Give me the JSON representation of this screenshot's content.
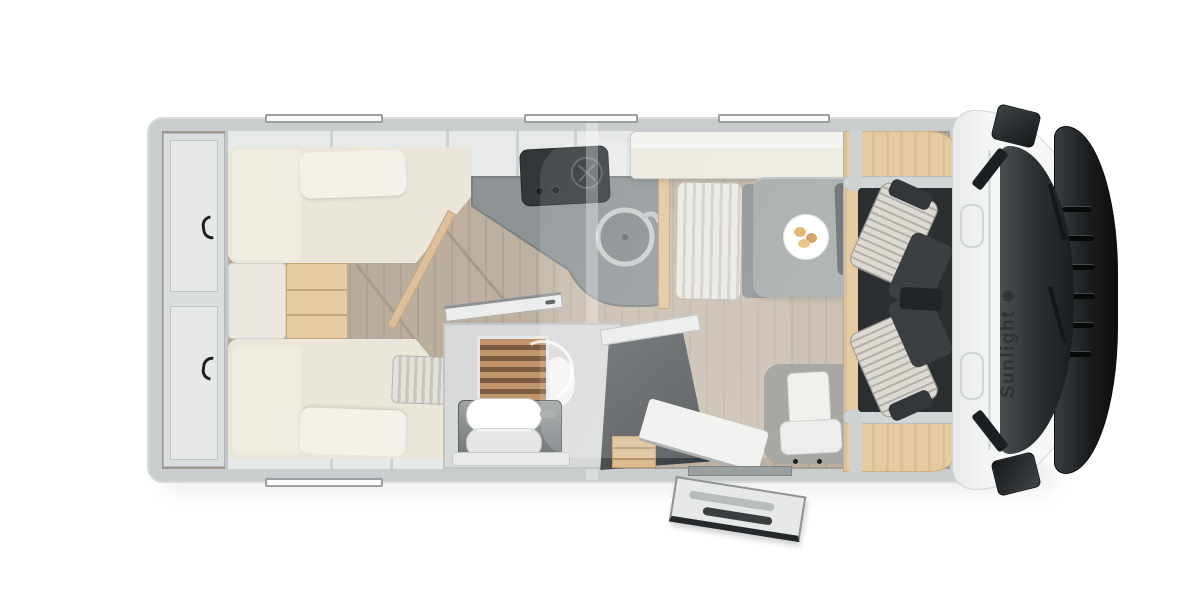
{
  "image": {
    "kind": "motorhome-floorplan-top-view",
    "background": "#ffffff"
  },
  "brand": {
    "logo_text": "Sunlight",
    "logo_icon": "sun-icon",
    "logo_icon_glyph": "❋",
    "logo_color": "#2f3335"
  },
  "colors": {
    "body_wall": "#c9cdce",
    "floor_wood": "#b8ab9c",
    "furniture_cream": "#eae6da",
    "accent_beech": "#e5cba3",
    "kitchen_counter": "#8d9395",
    "dark_charcoal": "#3b3f41",
    "cab_front_dark": "#17191b",
    "upholstery_stripe_light": "#dbd9d2",
    "shower_teak": "#a97f5e"
  },
  "furniture_zones": [
    "rear-storage",
    "twin-bed-top",
    "twin-bed-bottom",
    "bed-steps",
    "overhead-cabinets",
    "kitchen-counter",
    "cooktop",
    "round-sink",
    "bathroom",
    "shower",
    "washbasin",
    "toilet",
    "wardrobe",
    "drop-down-bed",
    "dinette-bench",
    "dinette-table",
    "dinner-plate",
    "entry-door-open",
    "entry-step",
    "cab-seat-top",
    "cab-seat-bottom",
    "dashboard-wood-trim",
    "windshield",
    "hood-grille",
    "side-mirror-top",
    "side-mirror-bottom",
    "wall-windows"
  ]
}
